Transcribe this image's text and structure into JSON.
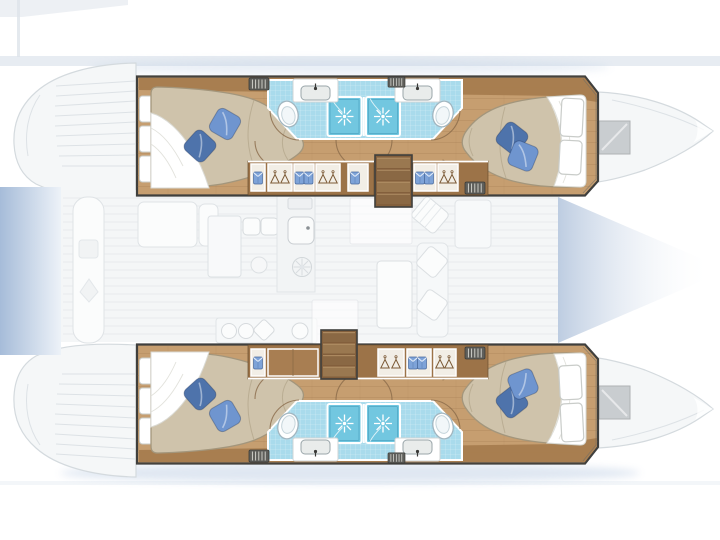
{
  "diagram": {
    "type": "yacht-floor-plan",
    "description": "Catamaran interior layout plan: two hulls each with aft and forward double cabins, two bathrooms with separate shower stalls back-to-back amidships, wardrobe-lined companionways with stairs, and a faded deck level showing transom steps, cockpit, galley, dinette, forepeak and bow hatches.",
    "vessel": {
      "style": "sailing catamaran",
      "hull_count": 2
    },
    "hulls": [
      {
        "side": "top",
        "rooms": [
          "aft double cabin",
          "aft bathroom with shower",
          "forward bathroom with shower",
          "forward double cabin",
          "companionway with wardrobes and stairs"
        ]
      },
      {
        "side": "bottom",
        "rooms": [
          "aft double cabin",
          "aft bathroom with shower",
          "forward bathroom with shower",
          "forward double cabin",
          "companionway with wardrobes and stairs"
        ]
      }
    ],
    "deck_level_faded": [
      "transom steps",
      "aft platform",
      "cockpit bench and table",
      "galley counters with sink and burners",
      "dinette table and sofa",
      "forepeak shading",
      "bow deck hatches"
    ],
    "counts": {
      "cabins": 4,
      "double_beds": 4,
      "pillows": 8,
      "bathrooms": 4,
      "shower_stalls": 4,
      "toilets": 4,
      "washbasins": 4,
      "stairways": 2,
      "wardrobe_rows": 4,
      "vent_grilles": 6
    }
  },
  "colors": {
    "wood_floor": "#c69e70",
    "wood_wall": "#a67c4e",
    "wood_cabinet": "#9c7348",
    "wood_stair": "#835f3c",
    "hull_outline": "#3f3f3d",
    "mattress": "#cfc3ab",
    "sheet": "#ffffff",
    "pillow_light": "#6f95cf",
    "pillow_dark": "#4e73ab",
    "bath_floor": "#a9dbec",
    "shower_blue": "#72c7e0",
    "band": "#dfe5ee",
    "gradient_blue": "#a6bcd9",
    "hatch_gray": "#c9cdd0",
    "shadow_blue": "#b9cbe2",
    "fixture_stroke": "#a2b6c0"
  }
}
